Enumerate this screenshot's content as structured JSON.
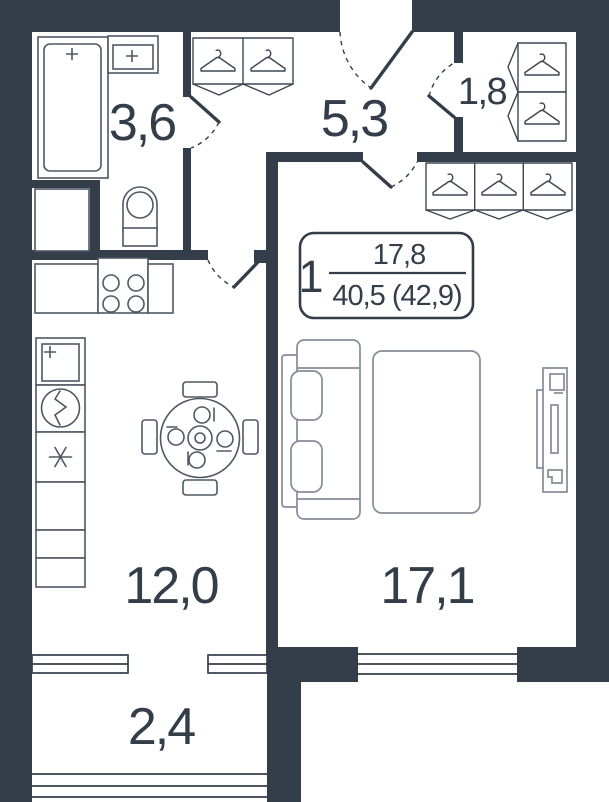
{
  "floor_plan": {
    "badge": {
      "rooms_count": "1",
      "living_area": "17,8",
      "total_area": "40,5 (42,9)"
    },
    "rooms": {
      "bathroom": {
        "area": "3,6"
      },
      "hallway": {
        "area": "5,3"
      },
      "wardrobe": {
        "area": "1,8"
      },
      "kitchen": {
        "area": "12,0"
      },
      "living_room": {
        "area": "17,1"
      },
      "balcony": {
        "area": "2,4"
      }
    },
    "colors": {
      "wall": "#333E4A",
      "text": "#333E4A",
      "furniture_outline": "#5A6370",
      "background": "#FFFFFF"
    }
  }
}
